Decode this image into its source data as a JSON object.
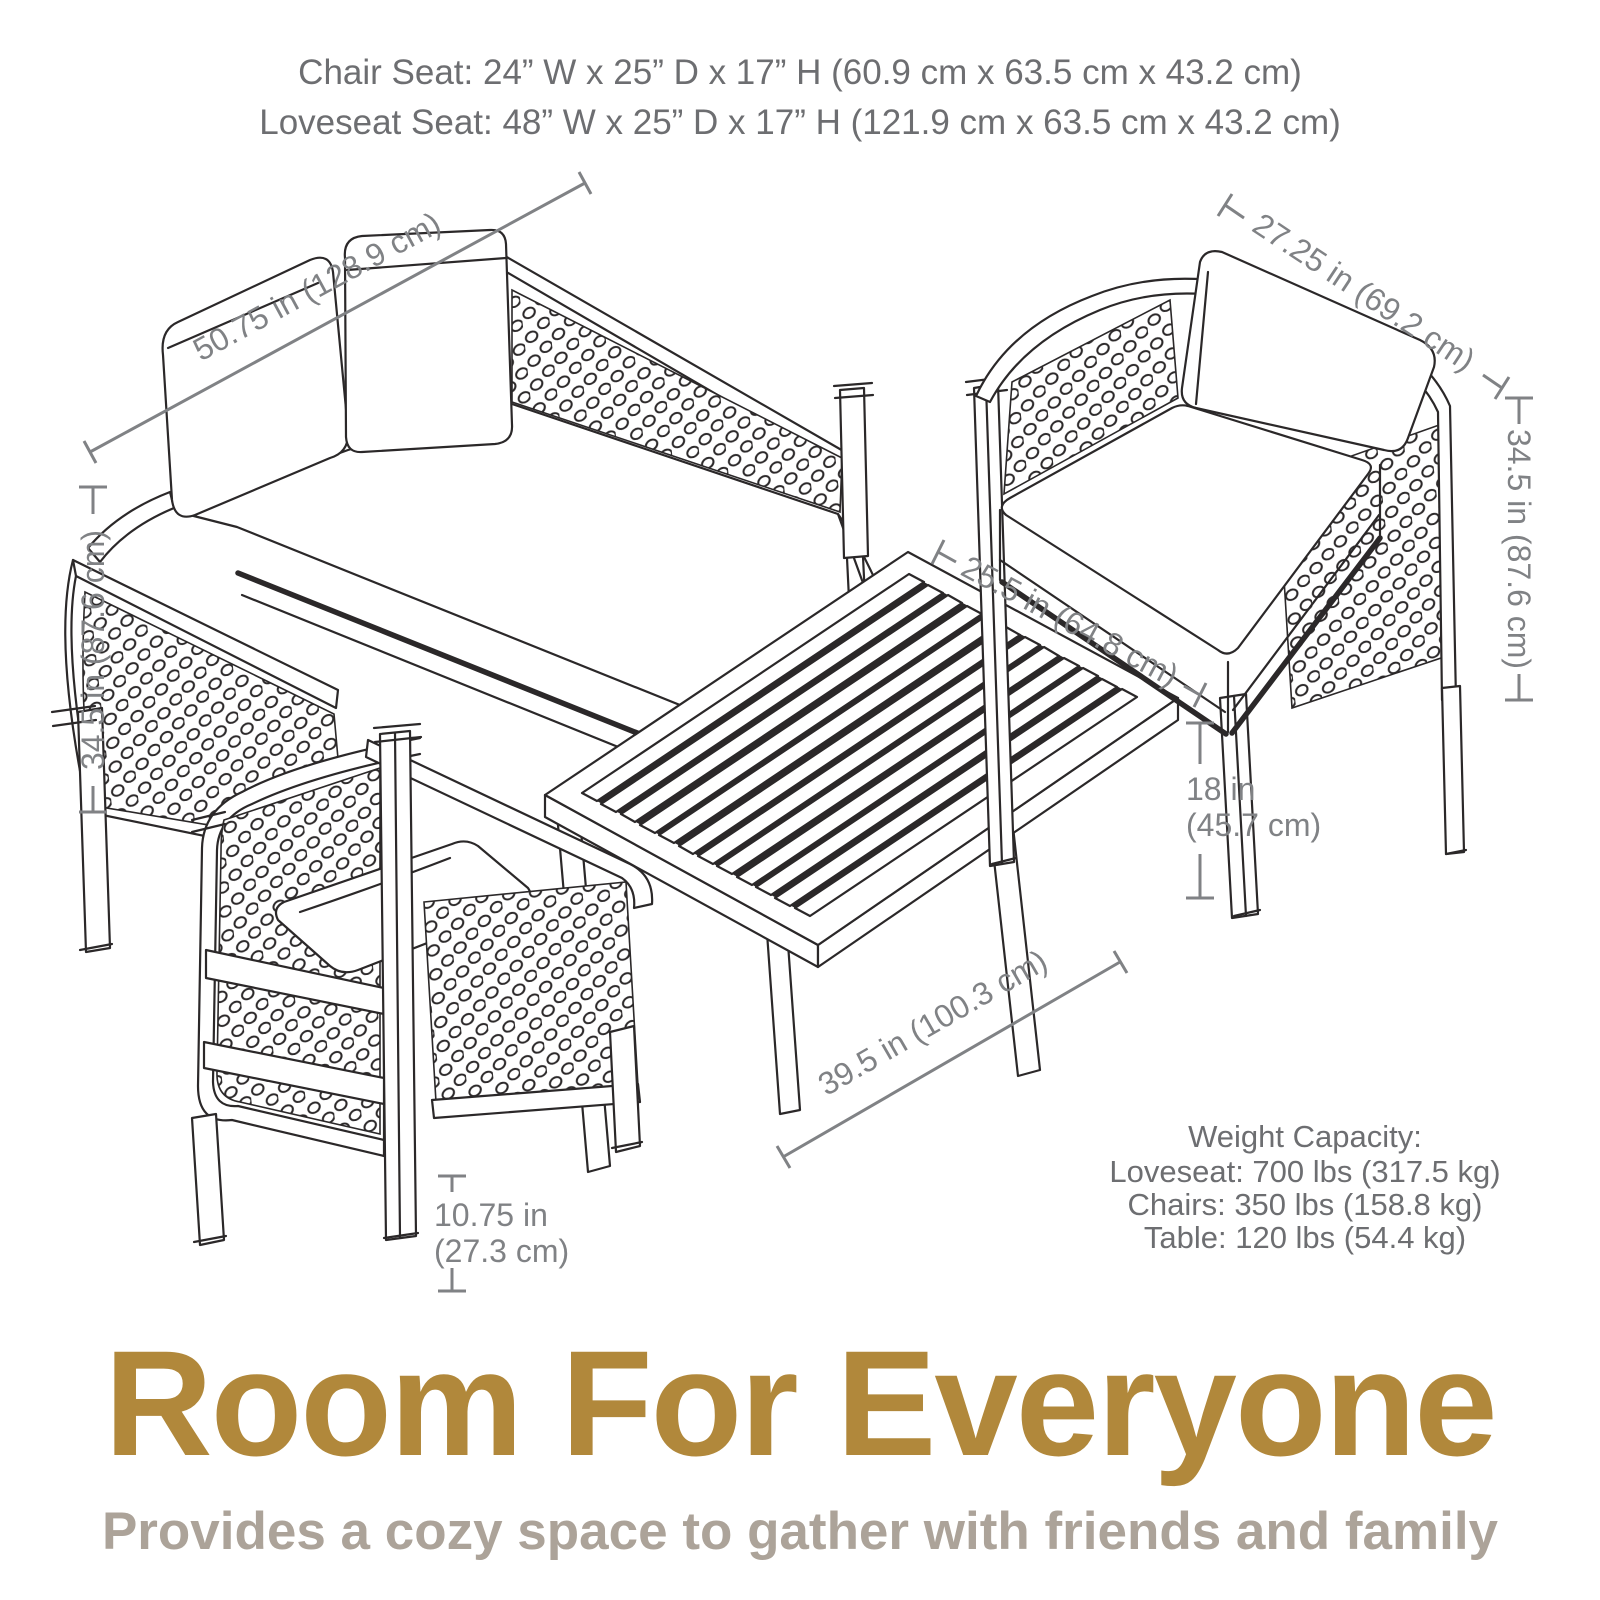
{
  "header": {
    "chair_seat": "Chair Seat: 24” W x 25” D x 17” H (60.9 cm x 63.5 cm x 43.2 cm)",
    "loveseat_seat": "Loveseat Seat: 48” W x 25” D x 17” H (121.9 cm x 63.5 cm x 43.2 cm)"
  },
  "dimensions": {
    "loveseat_width": "50.75 in (128.9 cm)",
    "chair_width": "27.25 in (69.2 cm)",
    "chair_height_right": "34.5 in (87.6 cm)",
    "loveseat_height_left": "34.5 in (87.6 cm)",
    "table_depth": "25.5 in (64.8 cm)",
    "table_height_line1": "18 in",
    "table_height_line2": "(45.7 cm)",
    "table_length": "39.5 in (100.3 cm)",
    "arm_height_line1": "10.75 in",
    "arm_height_line2": "(27.3 cm)"
  },
  "weight_capacity": {
    "title": "Weight Capacity:",
    "loveseat": "Loveseat: 700 lbs (317.5 kg)",
    "chairs": "Chairs: 350 lbs (158.8 kg)",
    "table": "Table: 120 lbs (54.4 kg)"
  },
  "footer": {
    "title": "Room For Everyone",
    "subtitle": "Provides a cozy space to gather with friends and family"
  },
  "colors": {
    "accent_gold": "#B1883B",
    "subtitle_gray": "#ACA399",
    "dimension_gray": "#808285",
    "text_gray": "#6D6E71",
    "line_art": "#2B2829"
  }
}
